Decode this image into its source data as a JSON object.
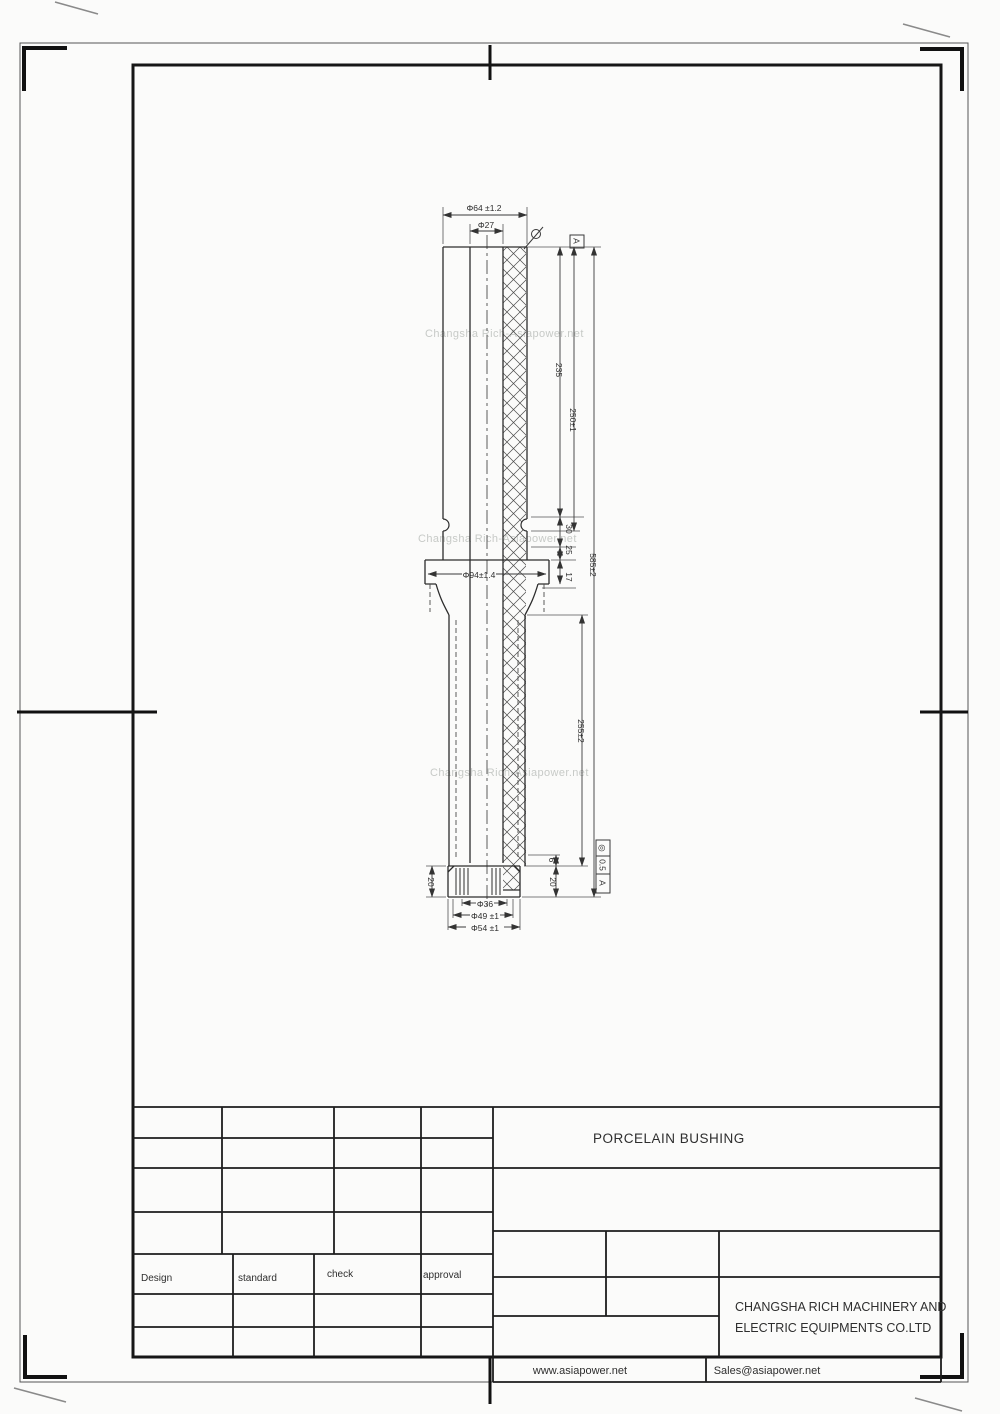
{
  "drawing": {
    "watermark": "Changsha Rich-Asiapower.net",
    "dims": {
      "dia_top_outer": "Φ64 ±1.2",
      "dia_top_bore": "Φ27",
      "dia_flange": "Φ94±1.4",
      "dia_bottom_inner": "Φ36",
      "dia_bottom_mid": "Φ49 ±1",
      "dia_bottom_outer": "Φ54 ±1",
      "len_top": "235",
      "len_top_tol": "250±1",
      "len_total": "585±2",
      "len_lower": "255±2",
      "step_30": "30",
      "step_25": "25",
      "step_17": "17",
      "cap_h_left": "20",
      "gap_6": "6",
      "cap_h_right": "20"
    },
    "datum": "A",
    "fcf": {
      "symbol": "◎",
      "value": "0.5",
      "datum": "A"
    }
  },
  "title_block": {
    "title": "PORCELAIN BUSHING",
    "company_line1": "CHANGSHA RICH MACHINERY AND",
    "company_line2": "ELECTRIC EQUIPMENTS CO.LTD",
    "design": "Design",
    "standard": "standard",
    "check": "check",
    "approval": "approval"
  },
  "footer": {
    "website": "www.asiapower.net",
    "email": "Sales@asiapower.net"
  }
}
